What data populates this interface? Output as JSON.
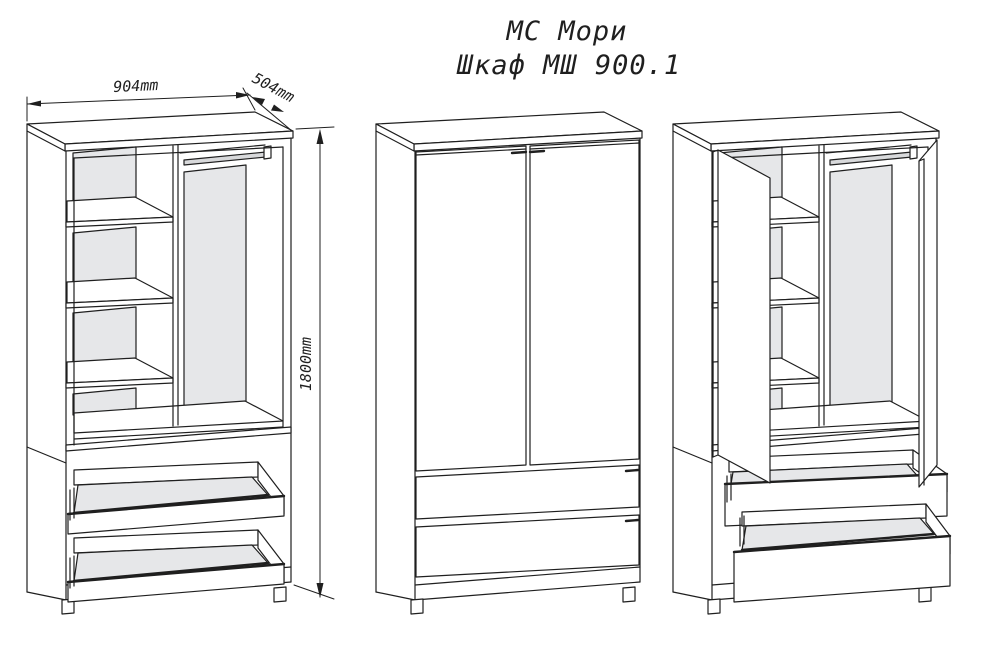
{
  "title": {
    "product_line": "МС Мори",
    "model": "Шкаф МШ 900.1"
  },
  "dimensions": {
    "width_label": "904mm",
    "depth_label": "504mm",
    "height_label": "1800mm"
  },
  "colors": {
    "line": "#1f1f1f",
    "panel": "#e6e7e9",
    "rod": "#d8d9db",
    "bg": "#ffffff"
  }
}
